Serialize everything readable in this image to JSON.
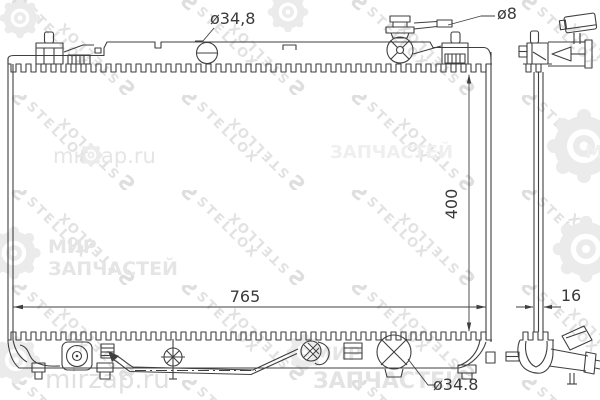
{
  "drawing": {
    "title": "radiator technical drawing, front and side views",
    "labels": {
      "filler_diameter": "ø34,8",
      "hose_diameter": "ø8",
      "core_height": "400",
      "core_width": "765",
      "core_thickness": "16",
      "outlet_diameter": "ø34.8"
    },
    "line_color": "#3f3f3f"
  },
  "watermark": {
    "brand": "STELLOX",
    "logo_glyph": "Ƨ",
    "site": "mirzap.ru",
    "site_prefix": "mir",
    "site_suffix": "ap.ru",
    "word_world": "МИР",
    "word_parts": "ЗАПЧАСТЕЙ",
    "text_color": "#e2e2e2"
  }
}
